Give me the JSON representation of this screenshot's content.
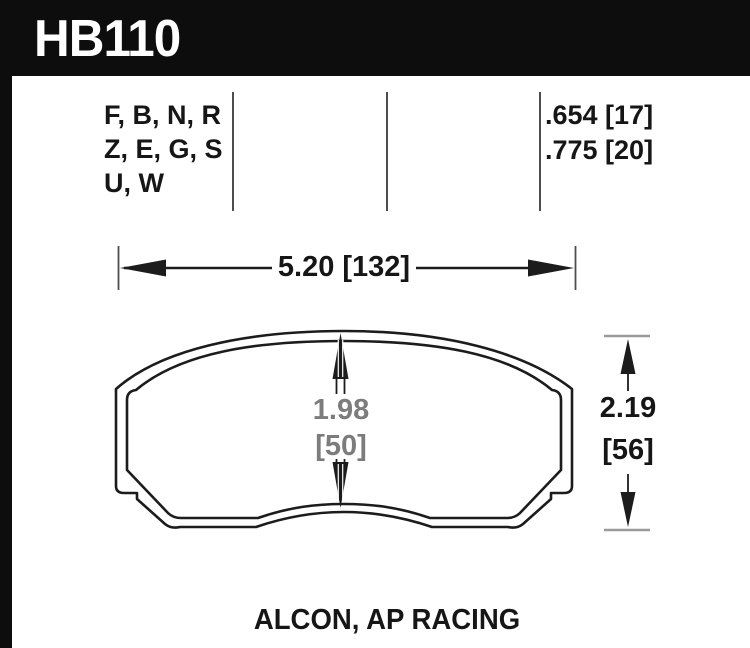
{
  "header": {
    "part_number": "HB110"
  },
  "spec_table": {
    "compound_lines": [
      "F, B, N, R",
      "Z, E, G, S",
      "U, W"
    ],
    "thickness_lines": [
      ".654 [17]",
      ".775 [20]"
    ]
  },
  "dimensions": {
    "width_label": "5.20 [132]",
    "pad_height_value": "1.98",
    "pad_height_mm": "[50]",
    "overall_height_value": "2.19",
    "overall_height_mm": "[56]"
  },
  "footer": {
    "applications": "ALCON, AP RACING"
  },
  "colors": {
    "frame_black": "#0d0d0d",
    "text_black": "#161616",
    "outline_black": "#1c1c1c",
    "dim_gray_text": "#7c7c7c",
    "tick_gray": "#9a9a9a",
    "divider_gray": "#4d4d4d",
    "background": "#ffffff"
  }
}
